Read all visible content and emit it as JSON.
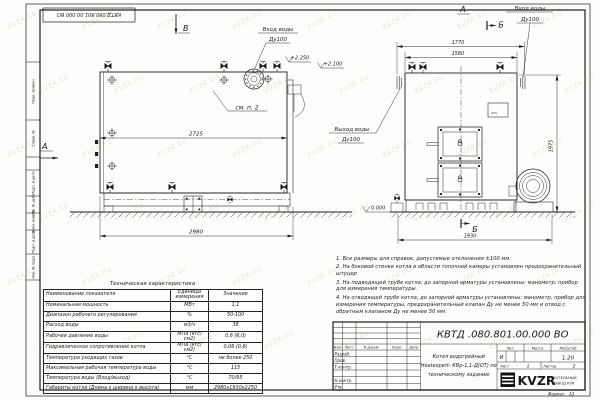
{
  "watermark": "KVZR.RU",
  "stamp_top": "КВТД.080.801.00.000 ВО",
  "margin_boxes": [
    "Перв. примен.",
    "Справ. №",
    "Подп. и дата",
    "Инв. № дубл.",
    "Взам. инв. №",
    "Подп. и дата",
    "Инв. № подл."
  ],
  "views": {
    "side": {
      "label_v": "В",
      "label_a": "А",
      "see_note": "см. п. 2",
      "dim_length_inner": "2725",
      "dim_length": "2980",
      "elev_top1": "+2.250",
      "elev_top2": "+2.100",
      "elev_ground": "0.000",
      "inlet_label": "Вход воды",
      "inlet_dn": "Ду100",
      "outlet_label": "Выход воды",
      "outlet_dn": "Ду100"
    },
    "front": {
      "label_a": "А",
      "label_b_top": "Б",
      "label_b_bottom": "Б",
      "dim_width_outer": "1770",
      "dim_width_inner": "1560",
      "dim_height": "1975",
      "dim_width_base": "1930",
      "inlet_label": "Вход воды",
      "inlet_dn": "Ду100"
    }
  },
  "spec_table": {
    "title": "Техническая характеристика",
    "columns": [
      "Наименование показателя",
      "Единицы измерения",
      "Значение"
    ],
    "rows": [
      [
        "Номинальная мощность",
        "МВт",
        "1,1"
      ],
      [
        "Диапазон рабочего регулирования",
        "%",
        "50-100"
      ],
      [
        "Расход воды",
        "м3/ч",
        "38"
      ],
      [
        "Рабочее давление воды",
        "МПа (кгс/см2)",
        "0,6 (6,0)"
      ],
      [
        "Гидравлическое сопротивление котла",
        "МПа (кгс/см2)",
        "0,06 (0,6)"
      ],
      [
        "Температура уходящих газов",
        "°С",
        "не более 250"
      ],
      [
        "Максимальная рабочая температура воды",
        "°С",
        "115"
      ],
      [
        "Температура воды (Вход/выход)",
        "°С",
        "70/95"
      ],
      [
        "Габариты котла (Длина х ширина х высота)",
        "мм",
        "2980х1930х2250"
      ]
    ]
  },
  "notes": [
    "1. Все размеры для справок, допустимые отклонения ±100 мм.",
    "2. На боковой стенке котла в области топочной камеры установлен предохранительный штуцер",
    "3. На подводящей трубе котла, до запорной арматуры установлены: манометр, прибор для измерения температуры.",
    "4. На отводящей трубе котла, до запорной арматуры установлены: манометр, прибор для измерения температуры, предохранительный клапан Ду не менее 50 мм и отвод с обратным клапаном Ду не менее 50 мм."
  ],
  "title_block": {
    "doc_number": "КВТД .080.801.00.000  ВО",
    "title_lines": [
      "Котел водогрейный",
      "Heatexpert- КВр-1,1-Д(ОТ) по",
      "техническому заданию"
    ],
    "header_cells": [
      "Изм.",
      "Лист",
      "N докум.",
      "Подп.",
      "Дата"
    ],
    "row_labels": [
      "Разраб.",
      "Пров.",
      "Т.контр.",
      "",
      "Н.контр.",
      "Утв."
    ],
    "lit_label": "Лит.",
    "mass_label": "Масса",
    "scale_label": "Масштаб",
    "lit_value": "И",
    "scale_value": "1:20",
    "sheet_label": "Лист",
    "sheet_value": "1",
    "sheets_label": "Листов",
    "sheets_value": "2",
    "logo_text": "KVZR",
    "logo_sub1": "КОТЕЛЬНЫЙ",
    "logo_sub2": "ЗАВОД РЭП",
    "format_label": "Формат",
    "format_value": "А3"
  }
}
